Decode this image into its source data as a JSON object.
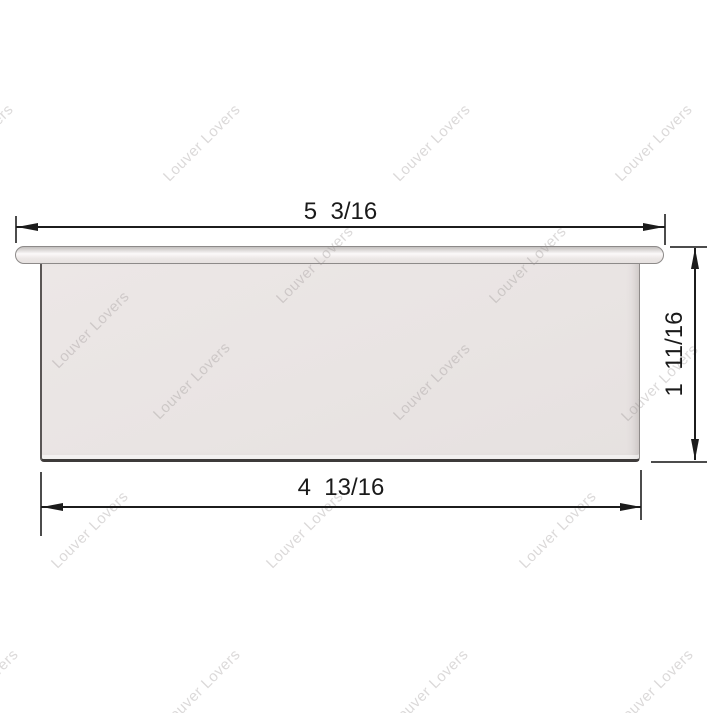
{
  "artwork": {
    "kind": "product technical drawing",
    "subject": "white louver frame cross-section with dimension callouts",
    "background_color": "#ffffff",
    "part_fill_color": "#e9e4e3",
    "part_outline_color": "#8d8a89",
    "part_bottom_edge_color": "#3e3b3a",
    "dimension_line_color": "#1b1b1b",
    "dimension_text_color": "#1a1a1a"
  },
  "dimensions": {
    "top": {
      "label": "5  3/16"
    },
    "right": {
      "label": "1  11/16"
    },
    "bottom": {
      "label": "4  13/16"
    }
  },
  "watermark": {
    "text": "Louver Lovers",
    "color": "rgba(150,144,144,0.34)",
    "angle_deg": -45,
    "font_size_px": 15,
    "positions": [
      {
        "x": -25,
        "y": 143
      },
      {
        "x": 202,
        "y": 143
      },
      {
        "x": 432,
        "y": 143
      },
      {
        "x": 654,
        "y": 143
      },
      {
        "x": 315,
        "y": 265
      },
      {
        "x": 528,
        "y": 265
      },
      {
        "x": 91,
        "y": 330
      },
      {
        "x": 192,
        "y": 381
      },
      {
        "x": 432,
        "y": 382
      },
      {
        "x": 660,
        "y": 383
      },
      {
        "x": 90,
        "y": 530
      },
      {
        "x": 305,
        "y": 530
      },
      {
        "x": 558,
        "y": 530
      },
      {
        "x": -20,
        "y": 688
      },
      {
        "x": 202,
        "y": 688
      },
      {
        "x": 430,
        "y": 688
      },
      {
        "x": 655,
        "y": 688
      }
    ]
  }
}
